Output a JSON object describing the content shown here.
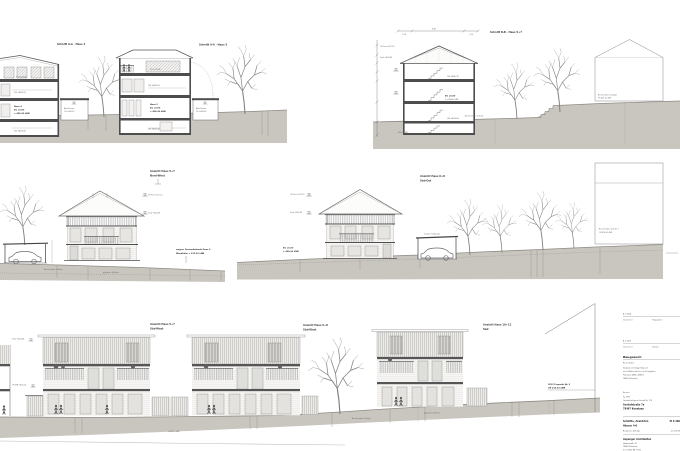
{
  "colors": {
    "terrain": "#c9c5bf",
    "line": "#4d4d4d",
    "accent": "#8f8b85"
  },
  "tl": {
    "a4": "Schnitt A-A · Haus 4",
    "a5": "Schnitt A-A · Haus 5",
    "h4_dg": "DG +412,45",
    "h4_og": "OG +409,15",
    "h4_name": "Haus 4",
    "h4_eg": "EG ±0,00",
    "h4_nn": "= 406,40 üNN",
    "h4_ug": "UG +403,30",
    "g1a": "Abstellraum",
    "g1b": "OK +409,90",
    "h5_dg": "DG +412,45",
    "h5_og": "OG +409,15",
    "h5_name": "Haus 5",
    "h5_eg": "EG ±0,00",
    "h5_nn": "= 406,40 üNN",
    "h5_ug": "UG +400,30",
    "g2a": "Abstellraum",
    "g2b": "OK +409,90"
  },
  "tr": {
    "b": "Schnitt B-B · Haus 5+7",
    "dim": "8,49",
    "dim_l": "1,24",
    "dim_r": "1,24",
    "m1": "OK First +417,35",
    "m2": "Trauf +414,85",
    "og": "OG +409,75",
    "eg": "EG ±0,00",
    "nn": "= +406,40 üNN",
    "ug": "UG +403,30",
    "gel": "Bestehendes Gelände",
    "nn2": "410,0 ü NN",
    "nb1": "Bestehendes Gebäude",
    "nb2": "OK 425,10 üNN"
  },
  "ml": {
    "l1": "Ansicht Haus 5+7",
    "l2": "Nord-West",
    "m1": "OK First +417,10",
    "m2": "Trauf +414,85",
    "n1": "wegen: Grenzabstände Haus 6",
    "n2": "Wandhöhe = 412,50 üNN",
    "t1": "Bestehendes Gelände",
    "t2": "geplantes Gelände"
  },
  "mr": {
    "l1": "Ansicht Haus 6+8",
    "l2": "Süd-Ost",
    "m1": "OK First +417,10",
    "m2": "Trauf +414,85",
    "eg1": "EG ±0,00",
    "eg2": "= 409,40 üNN",
    "cp": "Carport Tiefgarage",
    "nb1": "Bestehendes Geb. Nr. 7",
    "nb2": "OK 425,00 üNN"
  },
  "bt": {
    "l1a": "Ansicht Haus 5+7",
    "l1b": "Süd-West",
    "l2a": "Ansicht Haus 6+8",
    "l2b": "Süd-West",
    "l3a": "Ansicht Haus 10+12",
    "l3b": "Süd",
    "m1": "Trauf +414,85",
    "m2": "OK FFB +410,04",
    "t1": "Bestehendes Gelände",
    "t2": "geplantes Gelände",
    "t3": "+410,10 üNN",
    "bn1": "2013 Fixpunkt Nr. 9",
    "bn2": "OK 410,54 üNN"
  },
  "tb": {
    "r1_num": "A 1.1004",
    "r1_c1": "Gezeichnet",
    "r1_c2": "Freigegeben",
    "r2_num": "A 1.1005",
    "r2_c1": "Gezeichnet",
    "r2_c2": "Geprüft",
    "heading": "Baugesuch",
    "sub": "Bauvorhaben",
    "p1": "Neubau von Doppelhäusern",
    "p2": "mit 6 Wohneinheiten im Zentgraben",
    "p3": "Flurstück 4985, 4985/1",
    "p4": "78467 Konstanz",
    "owner_cap": "Bauherr",
    "owner1": "Fa. ZPG",
    "owner2": "Grundstücksgesellschaft Nr. 170",
    "owner3": "Seehofstraße 7a",
    "owner4": "78467 Konstanz",
    "sheet1": "Schnitte, Ansichten",
    "scale": "M 1:100",
    "sheet2": "Häuser 4-6",
    "index": "Bearbeitet 2013-A",
    "date": "21.3.2013",
    "arch": "Aspanger Architekten",
    "a1": "Hauptstraße 21",
    "a2": "78462 Konstanz",
    "a3": "Tel. 07531 88 77 66",
    "a4": "info@aspanger-architekten.de"
  }
}
